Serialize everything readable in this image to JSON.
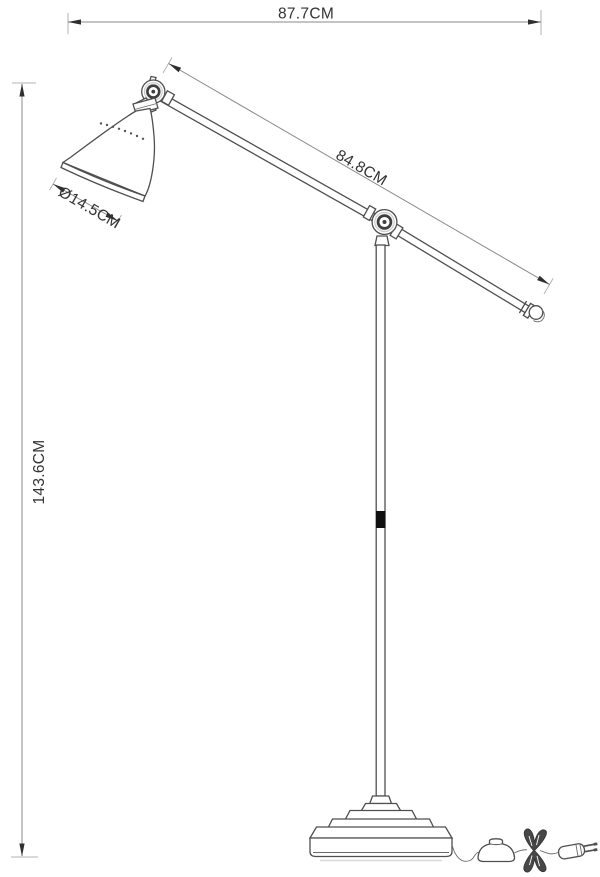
{
  "diagram": {
    "type": "technical-line-drawing",
    "subject": "floor lamp with adjustable arm, side view with dimension callouts",
    "unit": "CM",
    "colors": {
      "background": "#ffffff",
      "object_line": "#4f4f4f",
      "dimension_line": "#8a8a8a",
      "text": "#333333",
      "adjustment_mark": "#101010"
    },
    "dimensions": {
      "overall_width": {
        "label": "87.7CM",
        "value": 87.7,
        "orientation": "horizontal-top"
      },
      "arm_length": {
        "label": "84.8CM",
        "value": 84.8,
        "orientation": "diagonal-along-arm"
      },
      "shade_diameter": {
        "label": "Ø14.5CM",
        "value": 14.5,
        "orientation": "diagonal-at-shade-mouth"
      },
      "overall_height": {
        "label": "143.6CM",
        "value": 143.6,
        "orientation": "vertical-left"
      }
    },
    "parts": [
      "lamp shade",
      "top pivot joint",
      "upper arm",
      "elbow joint",
      "lower arm",
      "arm end cap",
      "vertical pole",
      "height adjustment mark",
      "stepped round base",
      "power cord",
      "foot switch",
      "cord bundle",
      "power plug"
    ]
  }
}
